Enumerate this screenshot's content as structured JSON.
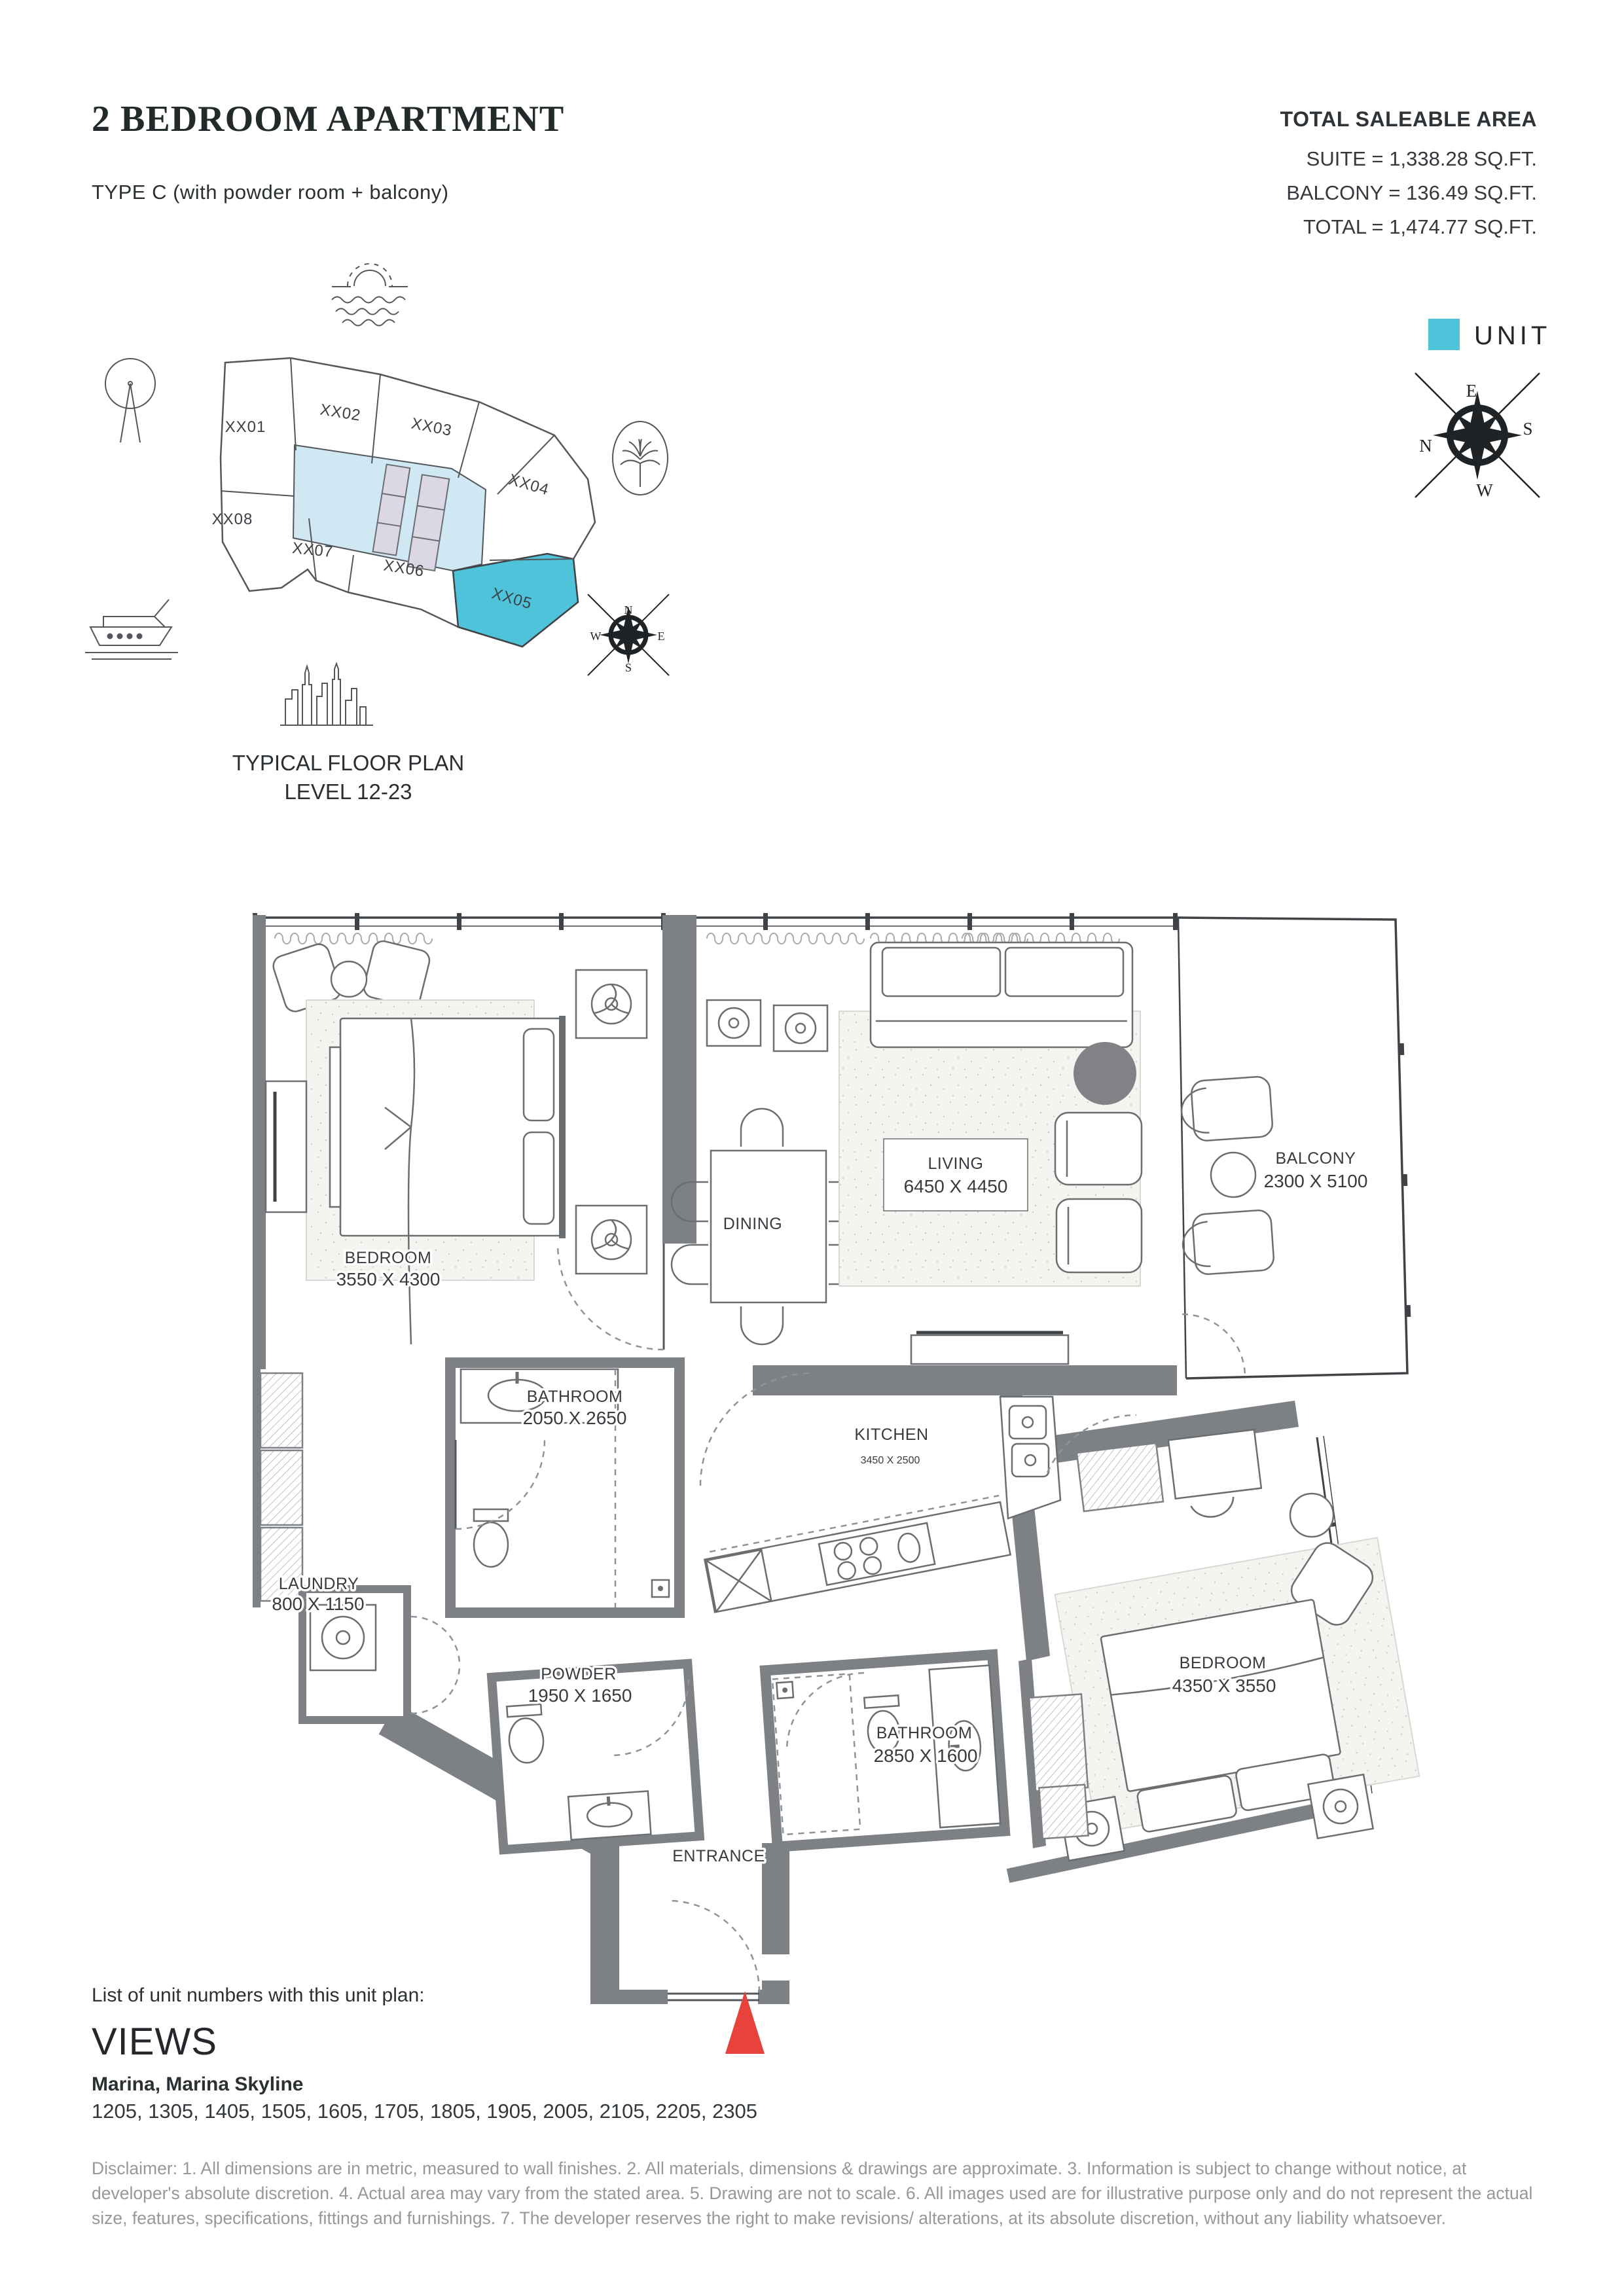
{
  "header": {
    "title": "2 BEDROOM APARTMENT",
    "subtitle": "TYPE C (with powder room + balcony)",
    "area_heading": "TOTAL SALEABLE AREA",
    "area_suite": "SUITE = 1,338.28 SQ.FT.",
    "area_balcony": "BALCONY = 136.49 SQ.FT.",
    "area_total": "TOTAL = 1,474.77 SQ.FT."
  },
  "key_plan": {
    "caption_line1": "TYPICAL FLOOR PLAN",
    "caption_line2": "LEVEL 12-23",
    "legend_label": "UNIT",
    "highlighted_unit": "XX05",
    "units": [
      "XX01",
      "XX02",
      "XX03",
      "XX04",
      "XX05",
      "XX06",
      "XX07",
      "XX08"
    ],
    "colors": {
      "unit_highlight": "#4ec3d9",
      "core": "#cfe8f3",
      "elevator": "#dbd7e5",
      "wall": "#7d8084",
      "marker_red": "#e8423c"
    }
  },
  "compass": {
    "n": "N",
    "e": "E",
    "s": "S",
    "w": "W"
  },
  "floor_plan": {
    "rooms": [
      {
        "name": "BEDROOM",
        "dims": "3550 X 4300"
      },
      {
        "name": "BATHROOM",
        "dims": "2050 X 2650"
      },
      {
        "name": "DINING",
        "dims": ""
      },
      {
        "name": "LIVING",
        "dims": "6450 X 4450"
      },
      {
        "name": "BALCONY",
        "dims": "2300 X 5100"
      },
      {
        "name": "KITCHEN",
        "dims": "3450 X 2500"
      },
      {
        "name": "LAUNDRY",
        "dims": "800 X 1150"
      },
      {
        "name": "POWDER",
        "dims": "1950 X 1650"
      },
      {
        "name": "BATHROOM",
        "dims": "2850 X 1600"
      },
      {
        "name": "BEDROOM",
        "dims": "4350 X 3550"
      },
      {
        "name": "ENTRANCE",
        "dims": ""
      }
    ]
  },
  "footer": {
    "list_label": "List of unit numbers with this unit plan:",
    "views_heading": "VIEWS",
    "views_value": "Marina, Marina Skyline",
    "unit_numbers": "1205, 1305, 1405, 1505, 1605, 1705, 1805, 1905, 2005, 2105, 2205, 2305",
    "disclaimer": "Disclaimer: 1. All dimensions are in metric, measured to wall finishes. 2. All materials, dimensions & drawings are approximate. 3. Information is subject to change without notice, at developer's absolute discretion. 4. Actual area may vary from the stated area. 5. Drawing are not to scale. 6. All images used are for illustrative purpose only and do not represent the actual size, features, specifications, fittings and furnishings. 7. The developer reserves the right to make revisions/ alterations, at its absolute discretion, without any liability whatsoever."
  }
}
